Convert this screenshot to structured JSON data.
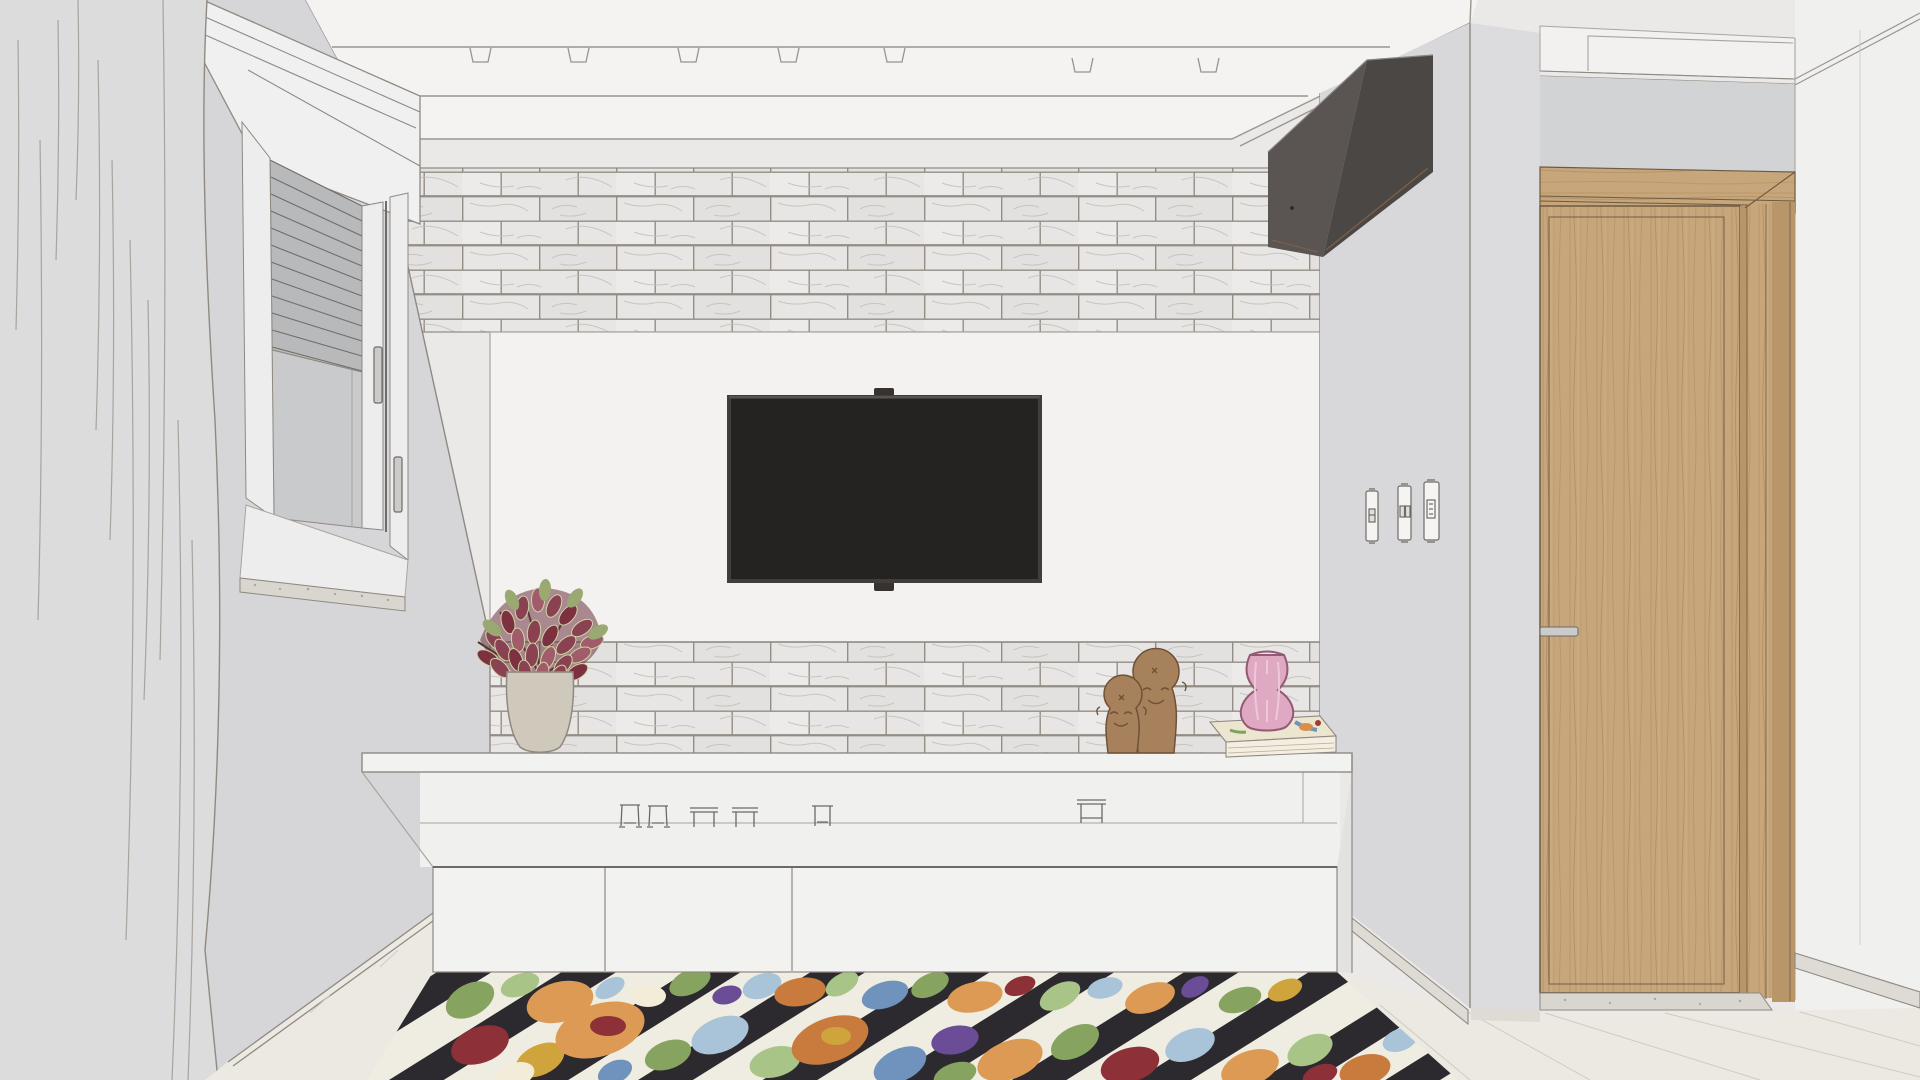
{
  "scene": {
    "description": "3D interior-design render (sketch style) of a living room TV wall",
    "elements": "curtain, window with roller blind, marble subway-tile accent wall, wall-mounted TV on white panel, recessed ceiling spotlights, air conditioner, light switches, wooden door, white TV console with decor, floral kilim rug, tile floor"
  },
  "objects": {
    "curtain": "sheer grey curtain",
    "window": "window with roller shutter blind",
    "brick_wall": "marble subway tile accent wall",
    "panel": "white TV back panel",
    "tv": "wall-mounted flat-screen TV",
    "spotlights": "recessed ceiling spotlights",
    "ac": "wall-mounted air conditioner unit",
    "switches": "light switch and outlet plates",
    "door": "wooden door",
    "console": "white TV console cabinet",
    "plant": "potted coleus plant in taupe vase",
    "sculptures": "two wooden head figurines",
    "book": "decor book",
    "pink_vase": "pink glass vase",
    "rug": "floral kilim rug with black and cream stripes",
    "floor": "light cream tile floor",
    "miniatures": "miniature furniture decor pieces"
  },
  "colors": {
    "bg": "#eae9e7",
    "ceiling": "#f4f3f1",
    "ceiling_line": "#9b958e",
    "wall_left": "#d6d6d8",
    "curtain": "#dcdcdd",
    "curtain_fold": "#a8a39d",
    "pelmet": "#f0f0f1",
    "blind": "#b8b9bb",
    "blind_slat": "#706c68",
    "glass": "#c9cacc",
    "frame_white": "#ededee",
    "sill": "#d9d6d0",
    "brick_tile": "#e8e6e4",
    "brick_tile_alt": "#e3e1df",
    "brick_tile_light": "#edebe9",
    "brick_grout": "#948d85",
    "brick_vein": "#c2bfba",
    "panel": "#f3f2f0",
    "line_soft": "#a9a49e",
    "line_strong": "#8f8982",
    "tv_frame": "#413d3b",
    "tv_screen": "#252322",
    "tv_mount": "#35322f",
    "ac_front": "#5a5553",
    "ac_side": "#4b4745",
    "ac_accent": "#7c5e48",
    "wall_right": "#d8d8da",
    "wall_alcove": "#dcdcde",
    "wall_above_door": "#d2d3d5",
    "soffit_door": "#f2f1ef",
    "wall_far_right": "#f0f0ee",
    "door_wood": "#c6a67a",
    "door_wood_light": "#d2b488",
    "door_grain": "#ab8a5e",
    "door_edge": "#6e5a42",
    "door_jamb": "#b8966a",
    "handle": "#cbcbcb",
    "switch_plate": "#f5f4f2",
    "switch_line": "#6f6b67",
    "console": "#f2f2f0",
    "console_recess": "#f0f1ef",
    "console_side": "#e2e2e0",
    "console_edge": "#6e6962",
    "vase_taupe": "#cfc9bc",
    "plant_leaf": "#8a4252",
    "plant_leaf_dark": "#6d3240",
    "plant_leaf_light": "#ccd6a4",
    "plant_green": "#9aa871",
    "plant_stem": "#4a3a2c",
    "head_wood": "#a7815b",
    "head_outline": "#6f5136",
    "book_cover": "#ece5cf",
    "book_pages": "#f3eee0",
    "vase_pink": "#e0a9c3",
    "vase_pink_light": "#f0cbd9",
    "vase_pink_outline": "#925a73",
    "rug_dark": "#2c2a2e",
    "rug_cream": "#efece1",
    "rug_orange": "#dd9a55",
    "rug_orange_deep": "#c97b3e",
    "rug_green": "#86a45f",
    "rug_green_light": "#a8c487",
    "rug_blue": "#a9c4d9",
    "rug_blue_steel": "#6f93bd",
    "rug_purple": "#6a4d96",
    "rug_red": "#8e3038",
    "rug_mustard": "#cfa43d",
    "rug_cream_flower": "#f2ecd9",
    "floor": "#ece9e2",
    "floor_line": "#cfcbc2",
    "baseboard": "#dedbd4"
  }
}
